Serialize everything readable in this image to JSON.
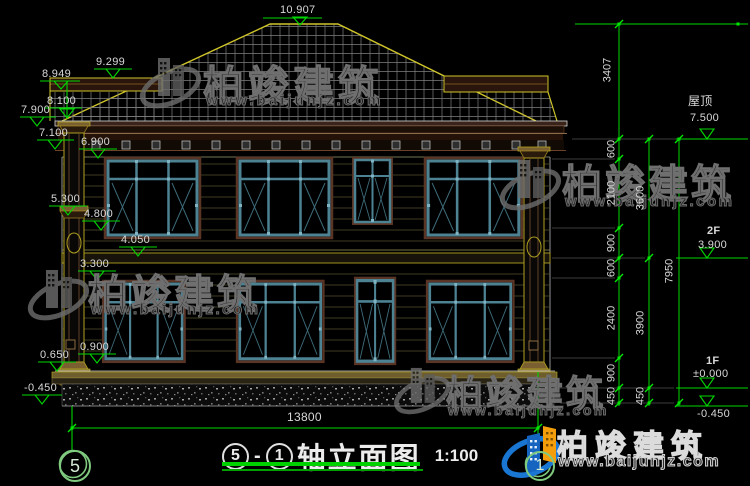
{
  "watermark": {
    "brand": "柏竣建筑",
    "url": "www.baijunjz.com"
  },
  "logo": {
    "brand": "柏竣建筑",
    "url": "www.baijunjz.com"
  },
  "levels_left": [
    "10.907",
    "9.299",
    "8.949",
    "8.100",
    "7.900",
    "7.100",
    "6.900",
    "5.300",
    "4.800",
    "4.050",
    "3.300",
    "0.900",
    "0.650",
    "-0.450"
  ],
  "levels_right": {
    "roof_label": "屋顶",
    "roof_value": "7.500",
    "f2_label": "2F",
    "f2_value": "3.900",
    "f1_label": "1F",
    "f1_value": "±0.000",
    "below_value": "-0.450"
  },
  "dims": {
    "vertical_total_top": "3407",
    "chain_inner": [
      "600",
      "2100",
      "900",
      "600",
      "2400",
      "900",
      "450"
    ],
    "chain_mid": [
      "3600",
      "3900",
      "450"
    ],
    "chain_outer": "7950",
    "bottom_width": "13800"
  },
  "axes": {
    "left_bubble": "5",
    "right_bubble": "1"
  },
  "title": {
    "axis_from": "5",
    "separator": "-",
    "axis_to": "1",
    "name": "轴立面图",
    "scale": "1:100"
  }
}
